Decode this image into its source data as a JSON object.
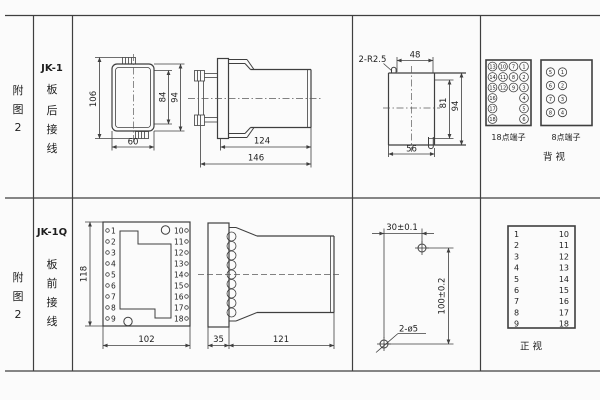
{
  "colors": {
    "line": "#3f3f3f",
    "text": "#1e1e1e",
    "bg": "#fbfbfb"
  },
  "row1": {
    "fig": [
      "附",
      "图",
      "2"
    ],
    "model": "JK-1",
    "wiring": [
      "板",
      "后",
      "接",
      "线"
    ],
    "rear_view": {
      "h": "106",
      "w": "60",
      "inner": "84",
      "outer": "94"
    },
    "side_view": {
      "body": "124",
      "total": "146"
    },
    "cutout": {
      "note": "2-R2.5",
      "top": "48",
      "inner": "81",
      "outer": "94",
      "bottom": "56"
    },
    "t18": {
      "label": "18点端子",
      "r0": [
        "13",
        "10",
        "7",
        "1"
      ],
      "r1": [
        "14",
        "11",
        "8",
        "2"
      ],
      "r2": [
        "15",
        "12",
        "9",
        "3"
      ],
      "r3": [
        "16",
        "4"
      ],
      "r4": [
        "17",
        "5"
      ],
      "r5": [
        "18",
        "6"
      ]
    },
    "t8": {
      "label": "8点端子",
      "left": [
        "5",
        "6",
        "7",
        "8"
      ],
      "right": [
        "1",
        "2",
        "3",
        "4"
      ]
    },
    "view": "背  视"
  },
  "row2": {
    "fig": [
      "附",
      "图",
      "2"
    ],
    "model": "JK-1Q",
    "wiring": [
      "板",
      "前",
      "接",
      "线"
    ],
    "front_view": {
      "h": "118",
      "w": "102",
      "left": [
        "1",
        "2",
        "3",
        "4",
        "5",
        "6",
        "7",
        "8",
        "9"
      ],
      "right": [
        "10",
        "11",
        "12",
        "13",
        "14",
        "15",
        "16",
        "17",
        "18"
      ]
    },
    "side_view": {
      "plate": "35",
      "body": "121"
    },
    "drill": {
      "w": "30±0.1",
      "h": "100±0.2",
      "note": "2-ø5"
    },
    "table": {
      "left": [
        "1",
        "2",
        "3",
        "4",
        "5",
        "6",
        "7",
        "8",
        "9"
      ],
      "right": [
        "10",
        "11",
        "12",
        "13",
        "14",
        "15",
        "16",
        "17",
        "18"
      ],
      "view": "正  视"
    }
  }
}
